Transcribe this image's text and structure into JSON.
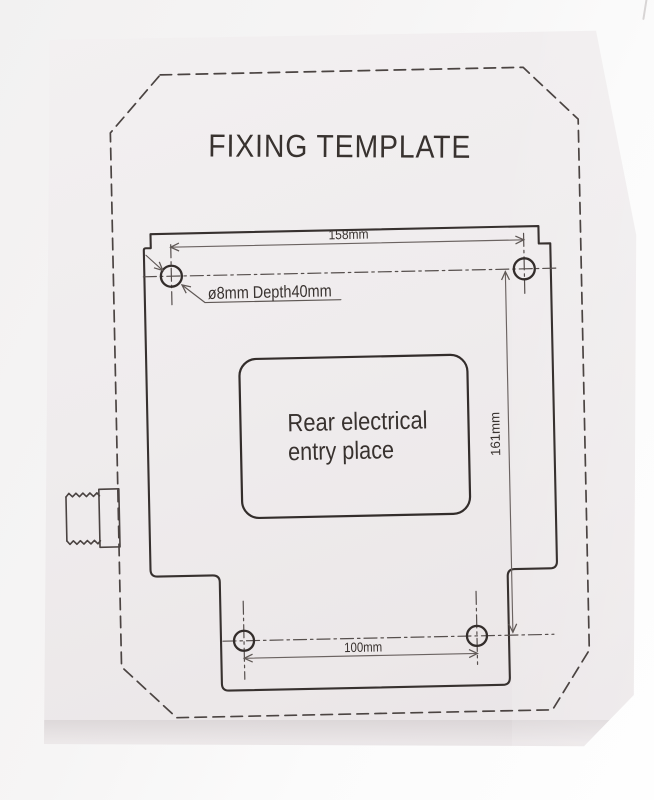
{
  "title": "FIXING TEMPLATE",
  "drawing": {
    "center_label": {
      "line1": "Rear electrical",
      "line2": "entry place"
    },
    "hole_annotation": "ø8mm Depth40mm",
    "dimensions": {
      "top_hole_spacing": "158mm",
      "right_hole_spacing": "161mm",
      "bottom_hole_spacing": "100mm"
    },
    "mounting_hole_count": 4,
    "colors": {
      "ink": "#37312f",
      "dimension_ink": "#6b6361",
      "paper": "#efeced",
      "background": "#f7f6f6"
    }
  }
}
